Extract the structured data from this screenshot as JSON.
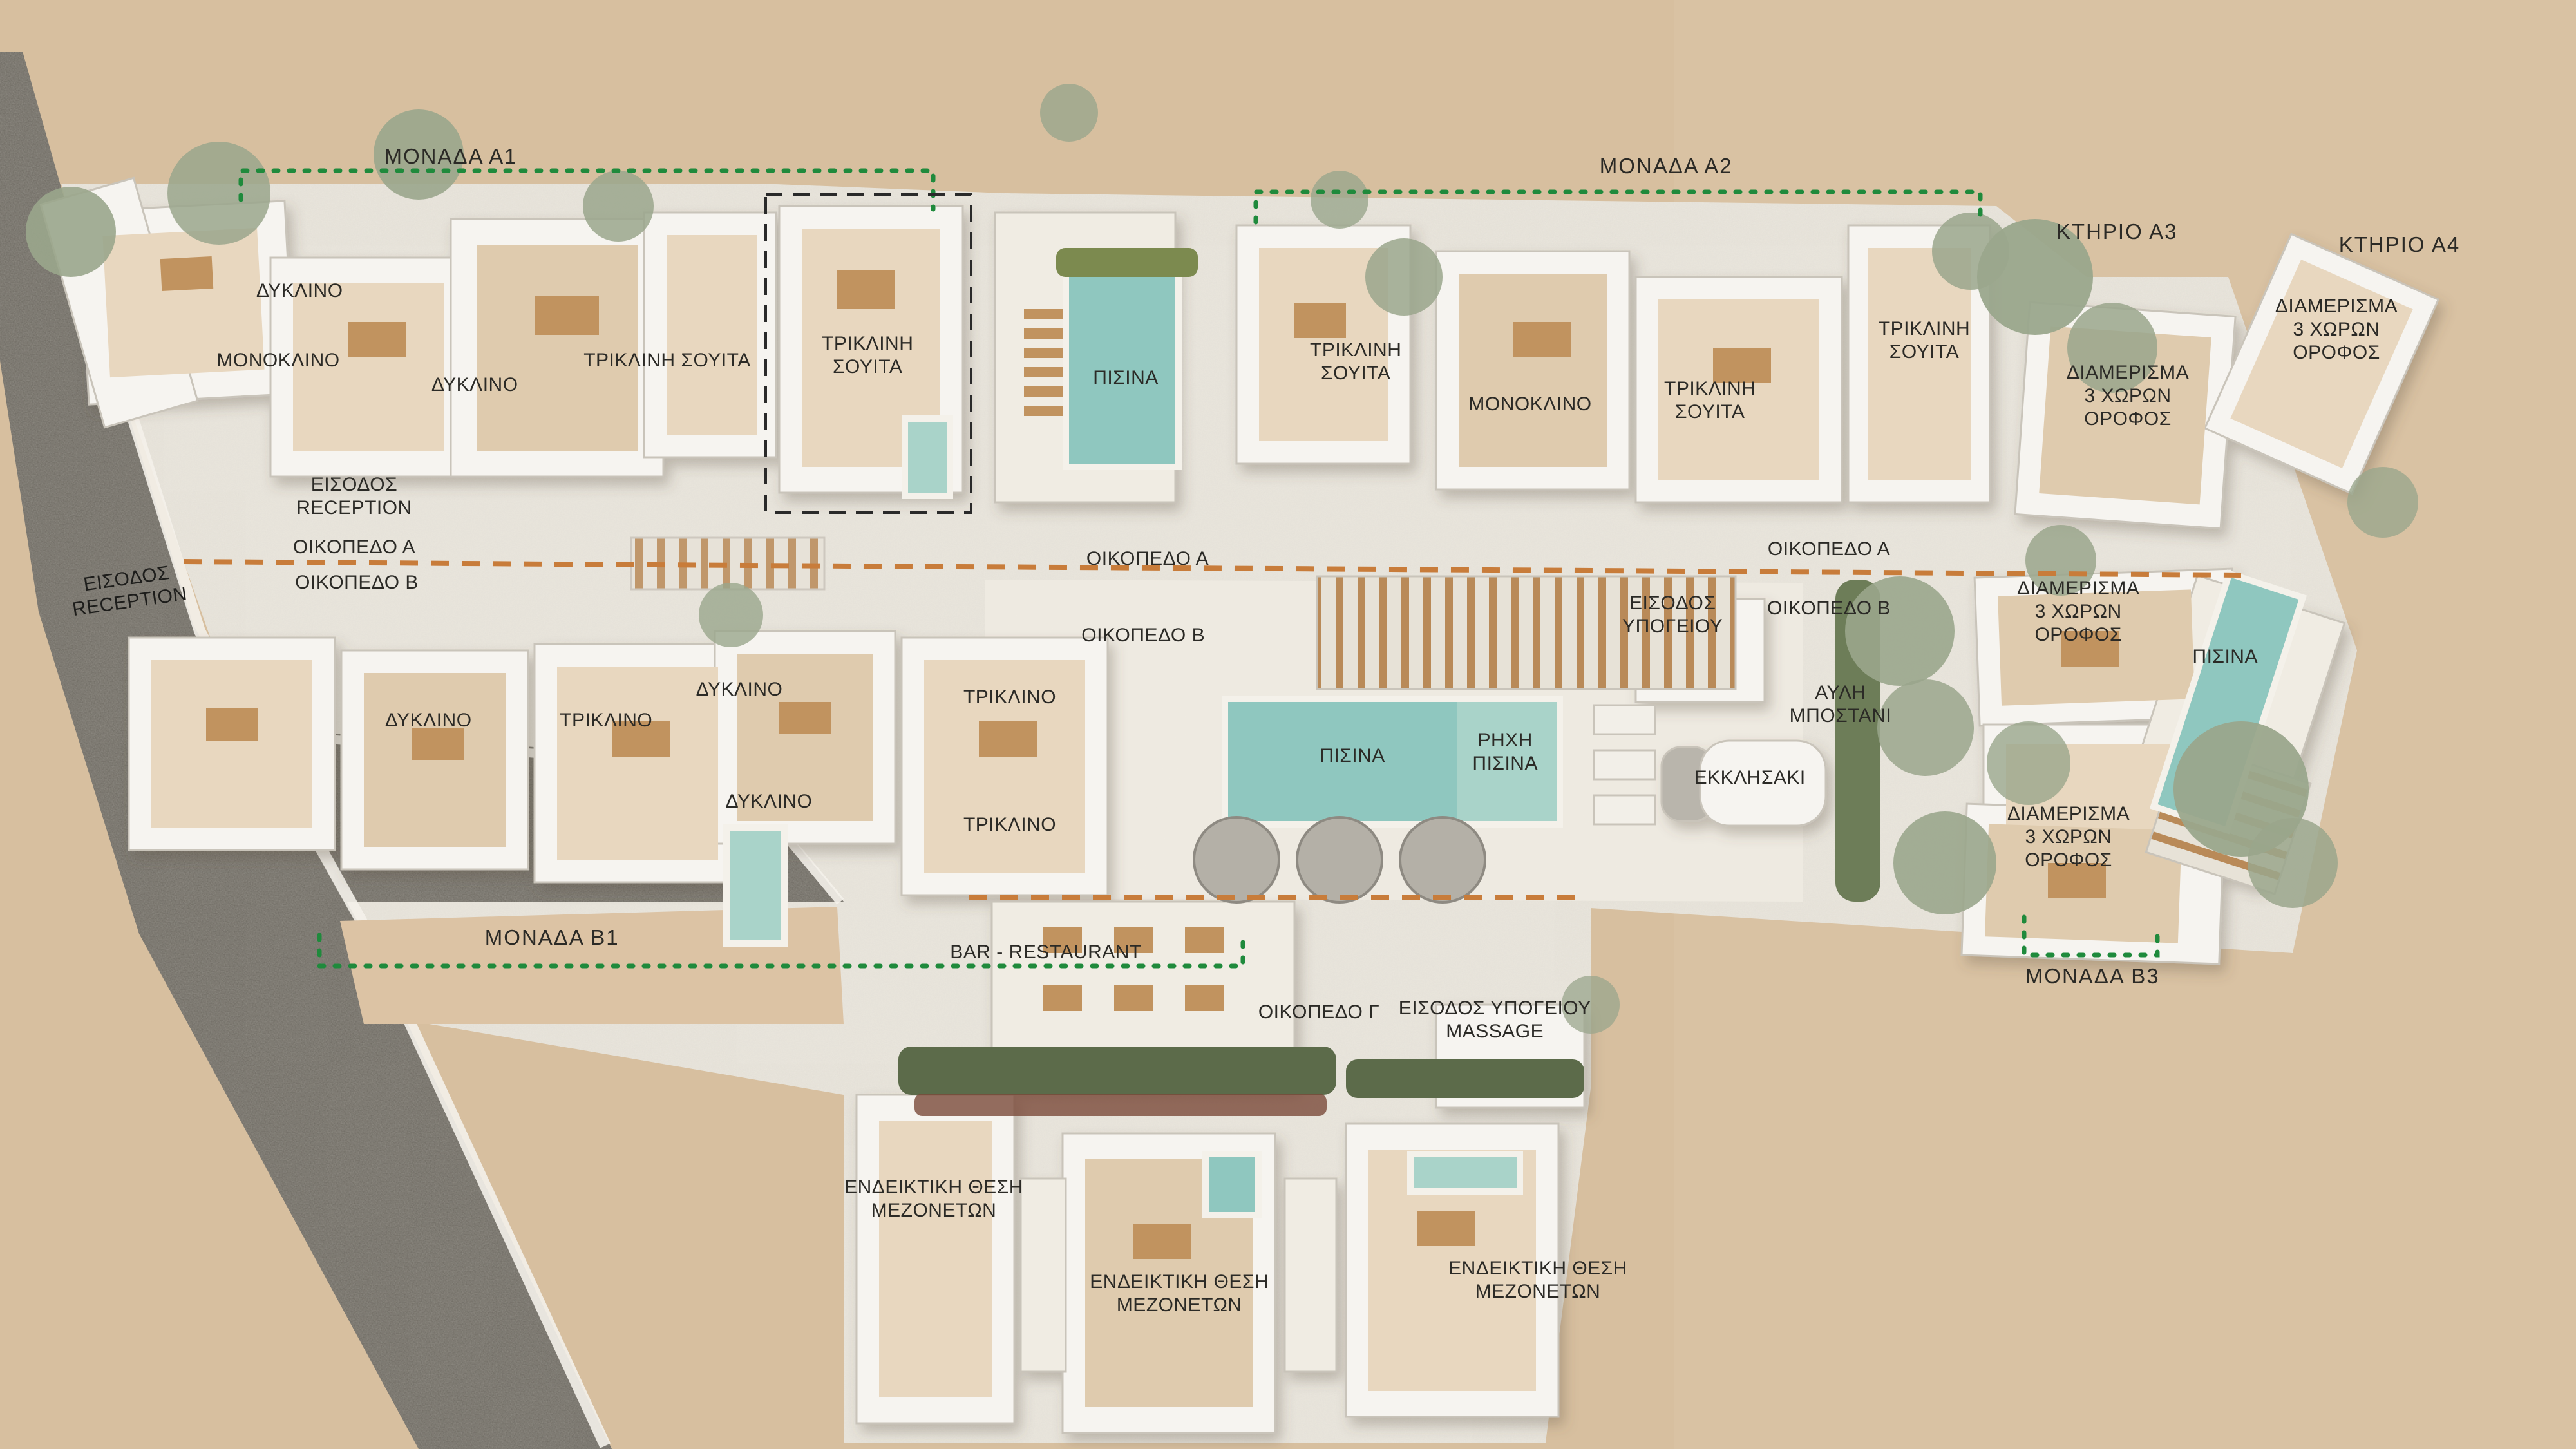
{
  "plan_title": "Resort site plan – aerial render (Greek labels)",
  "colors": {
    "sand": "#d7bf9f",
    "sand_light": "#dcc6a8",
    "road": "#6e6a62",
    "site": "#e9e5dc",
    "site_bright": "#f0ece3",
    "building": "#f6f4f0",
    "building_edge": "#c9c4ba",
    "room": "#e8d7bf",
    "room_dark": "#dfcbae",
    "wood": "#c0placeholder",
    "wood_main": "#c1935f",
    "pool": "#8fc7bf",
    "pool_shallow": "#a9d3c9",
    "green_dotted": "#1f8a3c",
    "orange_dashed": "#c87c3a",
    "black_dashed": "#2a2a2a",
    "hedge": "#5c6b4a",
    "tree": "#9aa68c",
    "label": "#2b2a26",
    "tan_area": "#dcc3a4",
    "umbrella": "#b4b0a7"
  },
  "labels": [
    {
      "t": "ΜΟΝΑΔΑ Α1",
      "x": 17.5,
      "y": 10.8,
      "k": "title"
    },
    {
      "t": "ΜΟΝΑΔΑ Α2",
      "x": 64.68,
      "y": 11.47,
      "k": "title"
    },
    {
      "t": "ΚΤΗΡΙΟ Α3",
      "x": 82.18,
      "y": 16.0,
      "k": "title"
    },
    {
      "t": "ΚΤΗΡΙΟ Α4",
      "x": 93.15,
      "y": 16.89,
      "k": "title"
    },
    {
      "t": "ΜΟΝΑΔΑ Β1",
      "x": 21.43,
      "y": 64.71,
      "k": "title"
    },
    {
      "t": "ΜΟΝΑΔΑ Β3",
      "x": 81.23,
      "y": 67.38,
      "k": "title"
    },
    {
      "t": "ΔΥΚΛΙΝΟ",
      "x": 11.63,
      "y": 20.09
    },
    {
      "t": "ΜΟΝΟΚΛΙΝΟ",
      "x": 10.8,
      "y": 24.89
    },
    {
      "t": "ΔΥΚΛΙΝΟ",
      "x": 18.43,
      "y": 26.58
    },
    {
      "t": "ΤΡΙΚΛΙΝΗ ΣΟΥΙΤΑ",
      "x": 25.9,
      "y": 24.89
    },
    {
      "t": "ΤΡΙΚΛΙΝΗ\nΣΟΥΙΤΑ",
      "x": 33.68,
      "y": 24.53
    },
    {
      "t": "ΠΙΣΙΝΑ",
      "x": 43.7,
      "y": 26.09
    },
    {
      "t": "ΤΡΙΚΛΙΝΗ\nΣΟΥΙΤΑ",
      "x": 52.63,
      "y": 24.98
    },
    {
      "t": "ΜΟΝΟΚΛΙΝΟ",
      "x": 59.4,
      "y": 27.91
    },
    {
      "t": "ΤΡΙΚΛΙΝΗ\nΣΟΥΙΤΑ",
      "x": 66.38,
      "y": 27.64
    },
    {
      "t": "ΤΡΙΚΛΙΝΗ\nΣΟΥΙΤΑ",
      "x": 74.7,
      "y": 23.51
    },
    {
      "t": "ΔΙΑΜΕΡΙΣΜΑ\n3 ΧΩΡΩΝ\nΟΡΟΦΟΣ",
      "x": 82.6,
      "y": 27.33
    },
    {
      "t": "ΔΙΑΜΕΡΙΣΜΑ\n3 ΧΩΡΩΝ\nΟΡΟΦΟΣ",
      "x": 90.7,
      "y": 22.76
    },
    {
      "t": "ΕΙΣΟΔΟΣ\nRECEPTION",
      "x": 13.75,
      "y": 34.27
    },
    {
      "t": "ΕΙΣΟΔΟΣ\nRECEPTION",
      "x": 4.98,
      "y": 40.76,
      "r": -8,
      "k": "onroad"
    },
    {
      "t": "ΟΙΚΟΠΕΔΟ Α",
      "x": 13.75,
      "y": 37.78
    },
    {
      "t": "ΟΙΚΟΠΕΔΟ Β",
      "x": 13.85,
      "y": 40.22
    },
    {
      "t": "ΟΙΚΟΠΕΔΟ Α",
      "x": 44.55,
      "y": 38.58
    },
    {
      "t": "ΟΙΚΟΠΕΔΟ Β",
      "x": 44.38,
      "y": 43.87
    },
    {
      "t": "ΟΙΚΟΠΕΔΟ Α",
      "x": 71.0,
      "y": 37.91
    },
    {
      "t": "ΟΙΚΟΠΕΔΟ Β",
      "x": 71.0,
      "y": 42.0
    },
    {
      "t": "ΕΙΣΟΔΟΣ\nΥΠΟΓΕΙΟΥ",
      "x": 64.93,
      "y": 42.44
    },
    {
      "t": "ΑΥΛΗ\nΜΠΟΣΤΑΝΙ",
      "x": 71.45,
      "y": 48.62
    },
    {
      "t": "ΔΙΑΜΕΡΙΣΜΑ\n3 ΧΩΡΩΝ\nΟΡΟΦΟΣ",
      "x": 80.68,
      "y": 42.22
    },
    {
      "t": "ΠΙΣΙΝΑ",
      "x": 86.38,
      "y": 45.33
    },
    {
      "t": "ΠΙΣΙΝΑ",
      "x": 52.5,
      "y": 52.18
    },
    {
      "t": "ΡΗΧΗ\nΠΙΣΙΝΑ",
      "x": 58.43,
      "y": 51.91
    },
    {
      "t": "ΕΚΚΛΗΣΑΚΙ",
      "x": 67.93,
      "y": 53.69
    },
    {
      "t": "ΔΥΚΛΙΝΟ",
      "x": 16.63,
      "y": 49.73
    },
    {
      "t": "ΤΡΙΚΛΙΝΟ",
      "x": 23.53,
      "y": 49.73
    },
    {
      "t": "ΔΥΚΛΙΝΟ",
      "x": 28.7,
      "y": 47.6
    },
    {
      "t": "ΤΡΙΚΛΙΝΟ",
      "x": 39.2,
      "y": 48.13
    },
    {
      "t": "ΔΥΚΛΙΝΟ",
      "x": 29.85,
      "y": 55.33
    },
    {
      "t": "ΤΡΙΚΛΙΝΟ",
      "x": 39.2,
      "y": 56.93
    },
    {
      "t": "ΔΙΑΜΕΡΙΣΜΑ\n3 ΧΩΡΩΝ\nΟΡΟΦΟΣ",
      "x": 80.3,
      "y": 57.78
    },
    {
      "t": "BAR - RESTAURANT",
      "x": 40.6,
      "y": 65.73
    },
    {
      "t": "ΟΙΚΟΠΕΔΟ Γ",
      "x": 51.2,
      "y": 69.87
    },
    {
      "t": "ΕΙΣΟΔΟΣ ΥΠΟΓΕΙΟΥ\nMASSAGE",
      "x": 58.03,
      "y": 70.4
    },
    {
      "t": "ΕΝΔΕΙΚΤΙΚΗ ΘΕΣΗ\nΜΕΖΟΝΕΤΩΝ",
      "x": 36.25,
      "y": 82.76
    },
    {
      "t": "ΕΝΔΕΙΚΤΙΚΗ ΘΕΣΗ\nΜΕΖΟΝΕΤΩΝ",
      "x": 45.78,
      "y": 89.29
    },
    {
      "t": "ΕΝΔΕΙΚΤΙΚΗ ΘΕΣΗ\nΜΕΖΟΝΕΤΩΝ",
      "x": 59.7,
      "y": 88.36
    }
  ]
}
